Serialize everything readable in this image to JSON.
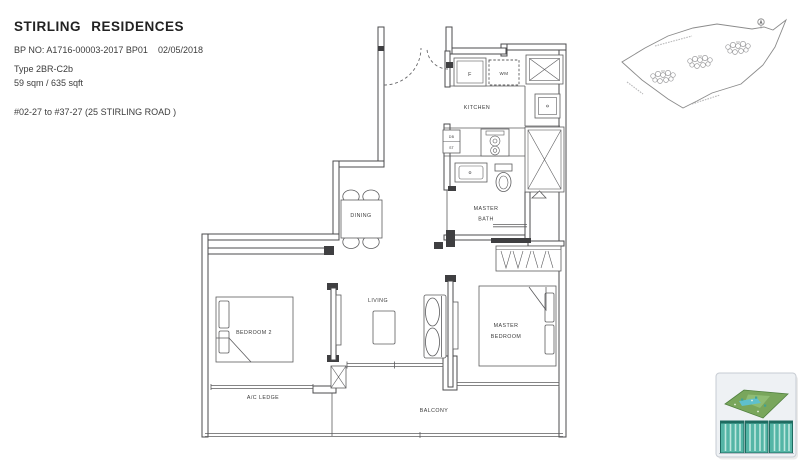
{
  "header": {
    "title": "STIRLING RESIDENCES",
    "bp_no": "BP NO: A1716-00003-2017 BP01",
    "bp_date": "02/05/2018",
    "unit_type": "Type 2BR-C2b",
    "area": "59 sqm / 635 sqft",
    "stack_info": "#02-27 to #37-27 (25 STIRLING ROAD )"
  },
  "floorplan": {
    "labels": {
      "kitchen": "KITCHEN",
      "master_bath_line1": "MASTER",
      "master_bath_line2": "BATH",
      "dining": "DINING",
      "living": "LIVING",
      "bedroom2": "BEDROOM 2",
      "master_bedroom_line1": "MASTER",
      "master_bedroom_line2": "BEDROOM",
      "ac_ledge": "A/C LEDGE",
      "balcony": "BALCONY",
      "fridge": "F",
      "washing_machine": "WM",
      "db": "DB",
      "st": "ST"
    }
  },
  "colors": {
    "wall": "#4b4b4d",
    "thin_line": "#5c5c5e",
    "label_text": "#3a3a3a",
    "site_outline": "#8b8b8b",
    "thumb_card_bg": "#eef1f4",
    "thumb_site_green": "#79a65c",
    "thumb_tower_teal": "#54b5a6",
    "thumb_tower_dark": "#1e6b60",
    "thumb_tower_stripe": "#bce6dd"
  }
}
